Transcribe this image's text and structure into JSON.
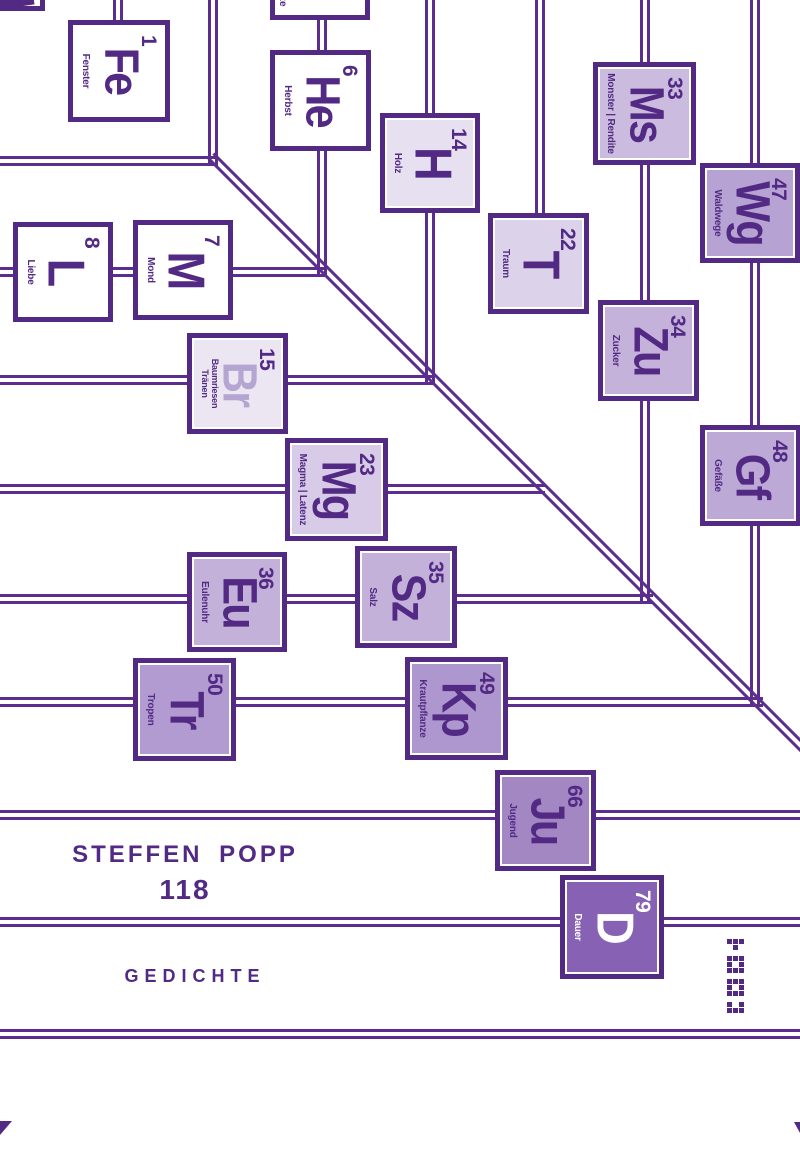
{
  "cover": {
    "author": "STEFFEN POPP",
    "title_number": "118",
    "subtitle": "GEDICHTE"
  },
  "colors": {
    "dark": "#522a84",
    "line": "#5b2d8e",
    "white": "#ffffff"
  },
  "elements": [
    {
      "id": "fe",
      "number": "1",
      "symbol": "Fe",
      "label": "Fenster",
      "x": 68,
      "y": 20,
      "size": 102,
      "fill": "#ffffff"
    },
    {
      "id": "he",
      "number": "6",
      "symbol": "He",
      "label": "Herbst",
      "x": 270,
      "y": 50,
      "size": 101,
      "fill": "#ffffff"
    },
    {
      "id": "h",
      "number": "14",
      "symbol": "H",
      "label": "Holz",
      "x": 380,
      "y": 113,
      "size": 100,
      "fill": "#e7e0f0"
    },
    {
      "id": "ms",
      "number": "33",
      "symbol": "Ms",
      "label": "Monster | Rendite",
      "x": 593,
      "y": 62,
      "size": 103,
      "fill": "#cbbbdf"
    },
    {
      "id": "wg",
      "number": "47",
      "symbol": "Wg",
      "label": "Waldwege",
      "x": 700,
      "y": 163,
      "size": 100,
      "fill": "#b7a3d3"
    },
    {
      "id": "l",
      "number": "8",
      "symbol": "L",
      "label": "Liebe",
      "x": 13,
      "y": 222,
      "size": 100,
      "fill": "#ffffff"
    },
    {
      "id": "m",
      "number": "7",
      "symbol": "M",
      "label": "Mond",
      "x": 133,
      "y": 220,
      "size": 100,
      "fill": "#ffffff"
    },
    {
      "id": "t",
      "number": "22",
      "symbol": "T",
      "label": "Traum",
      "x": 488,
      "y": 213,
      "size": 101,
      "fill": "#dcd2e9"
    },
    {
      "id": "zu",
      "number": "34",
      "symbol": "Zu",
      "label": "Zucker",
      "x": 598,
      "y": 300,
      "size": 101,
      "fill": "#c5b2db"
    },
    {
      "id": "br",
      "number": "15",
      "symbol": "Br",
      "label": "Baumriesen",
      "label2": "Tränen",
      "x": 187,
      "y": 333,
      "size": 101,
      "fill": "#ebe6f2",
      "symbol_color": "#b5a5d1"
    },
    {
      "id": "gf",
      "number": "48",
      "symbol": "Gf",
      "label": "Gefäße",
      "x": 700,
      "y": 425,
      "size": 101,
      "fill": "#bda9d6"
    },
    {
      "id": "mg",
      "number": "23",
      "symbol": "Mg",
      "label": "Magma | Latenz",
      "x": 285,
      "y": 438,
      "size": 103,
      "fill": "#d7cbe7"
    },
    {
      "id": "eu",
      "number": "36",
      "symbol": "Eu",
      "label": "Eulenuhr",
      "x": 187,
      "y": 552,
      "size": 100,
      "fill": "#c4b1da"
    },
    {
      "id": "sz",
      "number": "35",
      "symbol": "Sz",
      "label": "Salz",
      "x": 355,
      "y": 546,
      "size": 102,
      "fill": "#c4b1da"
    },
    {
      "id": "tr",
      "number": "50",
      "symbol": "Tr",
      "label": "Tropen",
      "x": 133,
      "y": 658,
      "size": 103,
      "fill": "#b19bd1"
    },
    {
      "id": "kp",
      "number": "49",
      "symbol": "Kp",
      "label": "Krautpflanze",
      "x": 405,
      "y": 657,
      "size": 103,
      "fill": "#ae97cf"
    },
    {
      "id": "ju",
      "number": "66",
      "symbol": "Ju",
      "label": "Jugend",
      "x": 495,
      "y": 770,
      "size": 101,
      "fill": "#a287c3"
    },
    {
      "id": "d",
      "number": "79",
      "symbol": "D",
      "label": "Dauer",
      "x": 560,
      "y": 875,
      "size": 104,
      "fill": "#8761b3",
      "text_color": "#ffffff"
    }
  ],
  "fragments": {
    "top_left_tile": {
      "x": -55,
      "y": -92,
      "size": 100
    },
    "top_tile": {
      "x": 270,
      "y": -80,
      "size": 100,
      "visible_label": "ze"
    }
  },
  "lines": {
    "horizontal": [
      {
        "y": 161,
        "x1": 0,
        "x2": 218
      },
      {
        "y": 272,
        "x1": 0,
        "x2": 327
      },
      {
        "y": 380,
        "x1": 0,
        "x2": 435
      },
      {
        "y": 489,
        "x1": 0,
        "x2": 545
      },
      {
        "y": 599,
        "x1": 0,
        "x2": 653
      },
      {
        "y": 702,
        "x1": 0,
        "x2": 763
      },
      {
        "y": 815,
        "x1": 0,
        "x2": 800
      },
      {
        "y": 922,
        "x1": 0,
        "x2": 800
      },
      {
        "y": 1034,
        "x1": 0,
        "x2": 800
      }
    ],
    "vertical": [
      {
        "x": 118,
        "y1": 0,
        "y2": 22
      },
      {
        "x": 213,
        "y1": 0,
        "y2": 166
      },
      {
        "x": 322,
        "y1": 18,
        "y2": 52
      },
      {
        "x": 322,
        "y1": 149,
        "y2": 277
      },
      {
        "x": 430,
        "y1": 0,
        "y2": 115
      },
      {
        "x": 430,
        "y1": 211,
        "y2": 385
      },
      {
        "x": 540,
        "y1": 0,
        "y2": 215
      },
      {
        "x": 645,
        "y1": 0,
        "y2": 64
      },
      {
        "x": 645,
        "y1": 160,
        "y2": 302
      },
      {
        "x": 645,
        "y1": 399,
        "y2": 604
      },
      {
        "x": 755,
        "y1": 0,
        "y2": 165
      },
      {
        "x": 755,
        "y1": 261,
        "y2": 427
      },
      {
        "x": 755,
        "y1": 524,
        "y2": 707
      }
    ],
    "diagonal": {
      "x": 211,
      "y": 156,
      "length": 845
    }
  },
  "publisher_logo": {
    "pattern": [
      "111",
      "010",
      "",
      "111",
      "101",
      "111",
      "",
      "111",
      "101",
      "111",
      "",
      "101",
      "111"
    ],
    "x": 727,
    "y": 939
  },
  "corners": {
    "bottom_left_chevron": {
      "x": 0,
      "y": 1121,
      "w": 12,
      "h": 14
    },
    "bottom_right_chevron": {
      "x": 794,
      "y": 1122,
      "w": 6,
      "h": 11
    }
  }
}
